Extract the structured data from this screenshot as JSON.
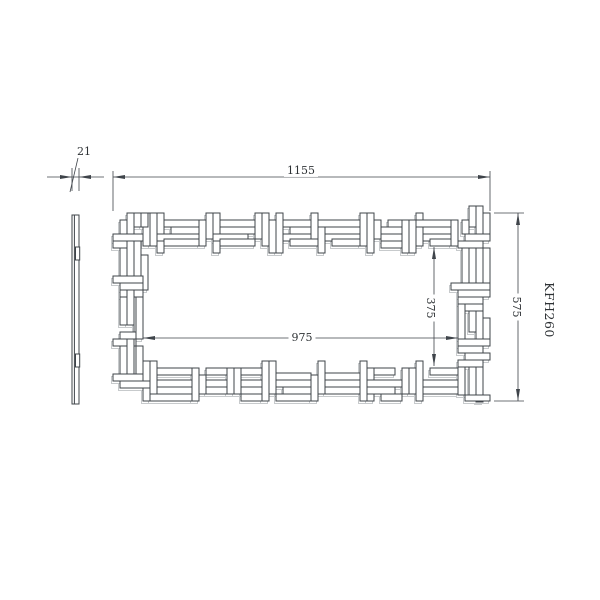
{
  "product": {
    "code": "KFH260"
  },
  "dimensions": {
    "overall_width": "1155",
    "overall_height": "575",
    "inner_width": "975",
    "inner_height": "375",
    "profile_thickness": "21"
  },
  "style": {
    "line_color": "#3f444a",
    "echo_color": "#c7cacc",
    "text_color": "#2e3235",
    "background": "#ffffff"
  },
  "pattern_seed": 42
}
